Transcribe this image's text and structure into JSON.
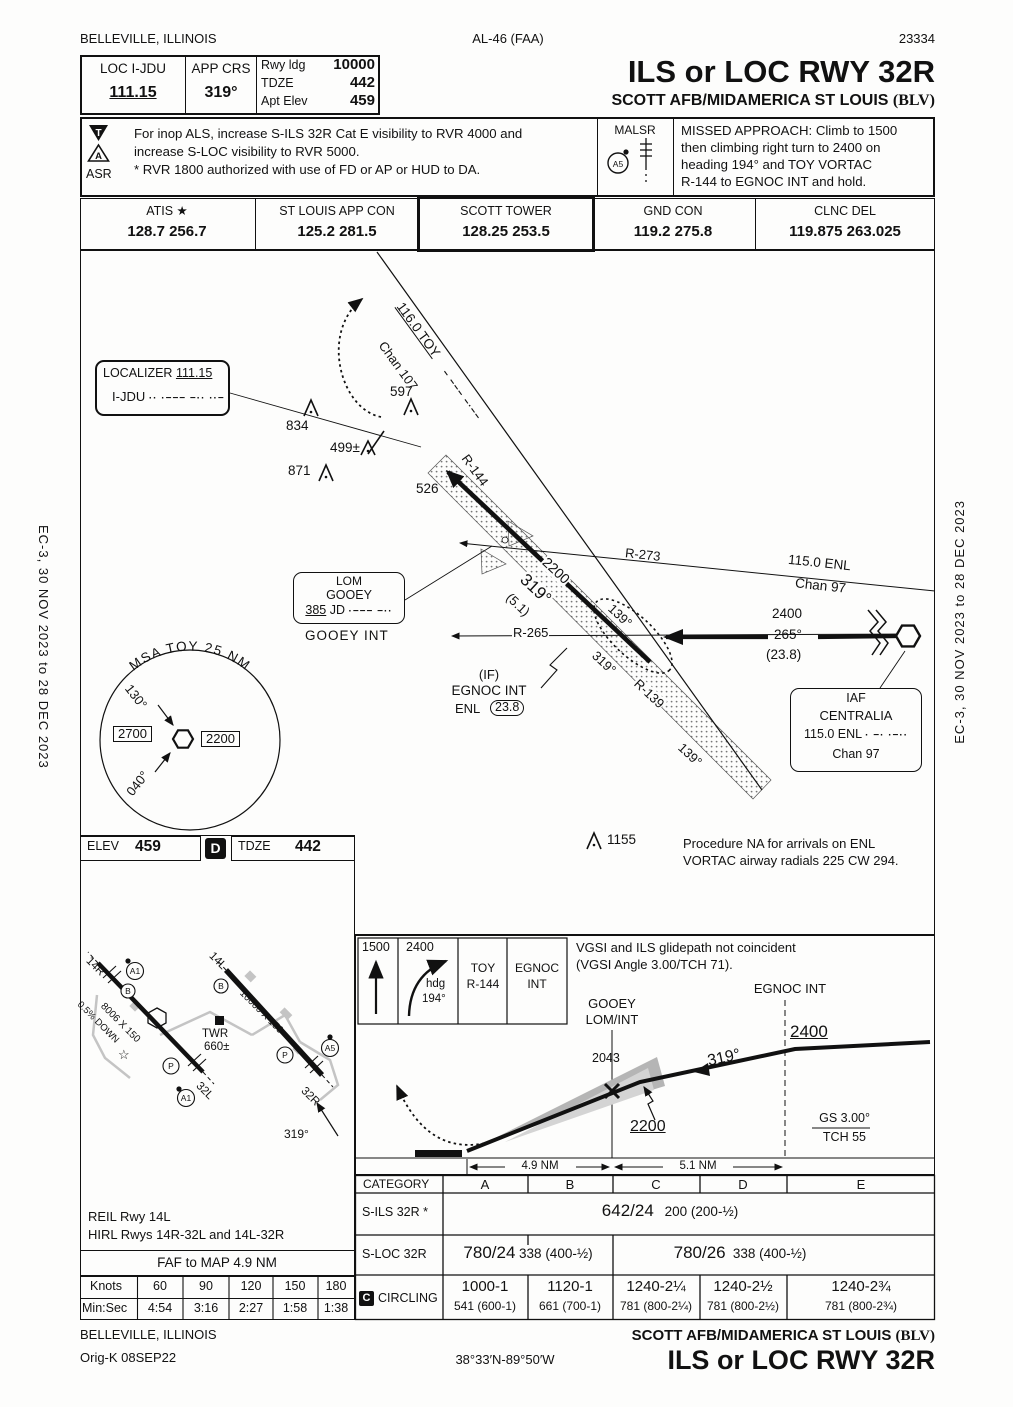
{
  "page": {
    "city": "BELLEVILLE, ILLINOIS",
    "ref": "AL-46 (FAA)",
    "number": "23334",
    "cycle": "EC-3,  30 NOV 2023  to  28 DEC 2023"
  },
  "briefing": {
    "loc_label": "LOC  I-JDU",
    "loc_freq": "111.15",
    "crs_label": "APP CRS",
    "crs_value": "319°",
    "rwy_ldg_label": "Rwy ldg",
    "rwy_ldg": "10000",
    "tdze_label": "TDZE",
    "tdze": "442",
    "apt_label": "Apt Elev",
    "apt": "459",
    "title": "ILS or LOC RWY 32R",
    "subtitle": "SCOTT AFB/MIDAMERICA ST LOUIS ",
    "subtitle_code": "(BLV)",
    "t_icon": "T",
    "a_icon": "A",
    "asr": "ASR",
    "note1": "For inop ALS, increase S-ILS 32R Cat E visibility to RVR 4000 and",
    "note2": "increase S-LOC visibility to RVR 5000.",
    "note3": "* RVR 1800 authorized with use of FD or AP or HUD to DA.",
    "malsr": "MALSR",
    "malsr_code": "A5",
    "missed1": "MISSED APPROACH: Climb to 1500",
    "missed2": "then climbing right turn to 2400 on",
    "missed3": "heading 194° and TOY VORTAC",
    "missed4": "R-144 to EGNOC INT and hold."
  },
  "freqs": {
    "cols": [
      {
        "name": "ATIS ★",
        "value": "128.7  256.7"
      },
      {
        "name": "ST LOUIS APP CON",
        "value": "125.2  281.5"
      },
      {
        "name": "SCOTT TOWER",
        "value": "128.25   253.5"
      },
      {
        "name": "GND CON",
        "value": "119.2   275.8"
      },
      {
        "name": "CLNC DEL",
        "value": "119.875  263.025"
      }
    ]
  },
  "plan": {
    "loc_name": "LOCALIZER",
    "loc_freq": "111.15",
    "loc_id": "I-JDU",
    "loc_morse": "··  ·−−−  −··  ··−",
    "toy_freq": "116.0 TOY",
    "toy_morse": "−  −−−  −·−−",
    "toy_chan": "Chan 107",
    "r144": "R-144",
    "r273": "R-273",
    "r265": "R-265",
    "r139": "R-139",
    "enl_line1": "115.0 ENL",
    "enl_line2": "Chan 97",
    "crs2200": "2200",
    "crs319": "319°",
    "crs51": "(5.1)",
    "hold139": "139°",
    "hold319": "319°",
    "tip139": "139°",
    "feeder_alt": "2400",
    "feeder_crs": "265°",
    "feeder_dist": "(23.8)",
    "o834": "834",
    "o597": "597",
    "o499": "499±",
    "o871": "871",
    "o526": "526",
    "o1155": "1155",
    "lom_t": "LOM",
    "lom_name": "GOOEY",
    "lom_freq": "385",
    "lom_id": "JD",
    "lom_morse": "·−−−  −··",
    "lom_int": "GOOEY  INT",
    "if_label": "(IF)",
    "if_name": "EGNOC INT",
    "if_nav": "ENL",
    "if_dist": "23.8",
    "iaf_t": "IAF",
    "iaf_name": "CENTRALIA",
    "iaf_freq": "115.0  ENL",
    "iaf_morse": "·  −·  ·−··",
    "iaf_chan": "Chan 97",
    "msa_arc": "MSA TOY 25 NM",
    "msa_brg1": "130°",
    "msa_brg2": "040°",
    "msa_alt1": "2700",
    "msa_alt2": "2200",
    "na_note1": "Procedure NA for arrivals on ENL",
    "na_note2": "VORTAC airway radials 225 CW 294."
  },
  "sketch": {
    "elev_label": "ELEV",
    "elev": "459",
    "d": "D",
    "tdze_label": "TDZE",
    "tdze": "442",
    "rwy14r": "14R",
    "rwy32l": "32L",
    "rwy14l": "14L",
    "rwy32r": "32R",
    "grad": "0.5% DOWN",
    "dim1": "8006 X 150",
    "dim2": "10000 X 150",
    "twr": "TWR",
    "twr_elev": "660±",
    "a1": "A1",
    "a5": "A5",
    "p": "P",
    "b": "B",
    "star": "☆",
    "brg": "319°",
    "lights1": "REIL Rwy 14L",
    "lights2": "HIRL Rwys 14R-32L and 14L-32R",
    "faf_map": "FAF to MAP  4.9 NM",
    "knots_label": "Knots",
    "knots": [
      "60",
      "90",
      "120",
      "150",
      "180"
    ],
    "minsec_label": "Min:Sec",
    "minsec": [
      "4:54",
      "3:16",
      "2:27",
      "1:58",
      "1:38"
    ]
  },
  "profile": {
    "ma1": "1500",
    "ma2": "2400",
    "ma2b": "hdg",
    "ma2c": "194°",
    "ma3a": "TOY",
    "ma3b": "R-144",
    "ma4a": "EGNOC",
    "ma4b": "INT",
    "vgsi1": "VGSI and ILS glidepath not coincident",
    "vgsi2": "(VGSI Angle 3.00/TCH 71).",
    "egnoc": "EGNOC INT",
    "gooey1": "GOOEY",
    "gooey2": "LOM/INT",
    "alt2400": "2400",
    "alt2200": "2200",
    "gp2043": "2043",
    "crs": "319°",
    "gs": "GS 3.00°",
    "tch": "TCH 55",
    "d49": "4.9 NM",
    "d51": "5.1 NM"
  },
  "minimums": {
    "category": "CATEGORY",
    "cats": [
      "A",
      "B",
      "C",
      "D",
      "E"
    ],
    "sils_label": "S-ILS 32R *",
    "sils_main": "642/24",
    "sils_sub": "200 (200-½)",
    "sloc_label": "S-LOC 32R",
    "sloc_ab_main": "780/24",
    "sloc_ab_sub": "338 (400-½)",
    "sloc_ce_main": "780/26",
    "sloc_ce_sub": "338 (400-½)",
    "circ_c": "C",
    "circ_label": "CIRCLING",
    "circling": [
      {
        "main": "1000-1",
        "sub": "541 (600-1)"
      },
      {
        "main": "1120-1",
        "sub": "661 (700-1)"
      },
      {
        "main": "1240-2¼",
        "sub": "781 (800-2¼)"
      },
      {
        "main": "1240-2½",
        "sub": "781 (800-2½)"
      },
      {
        "main": "1240-2¾",
        "sub": "781 (800-2¾)"
      }
    ]
  },
  "footer": {
    "city": "BELLEVILLE, ILLINOIS",
    "orig": "Orig-K  08SEP22",
    "coords": "38°33′N-89°50′W",
    "apt": "SCOTT AFB/MIDAMERICA ST LOUIS ",
    "apt_code": "(BLV)",
    "title": "ILS or LOC RWY 32R"
  }
}
